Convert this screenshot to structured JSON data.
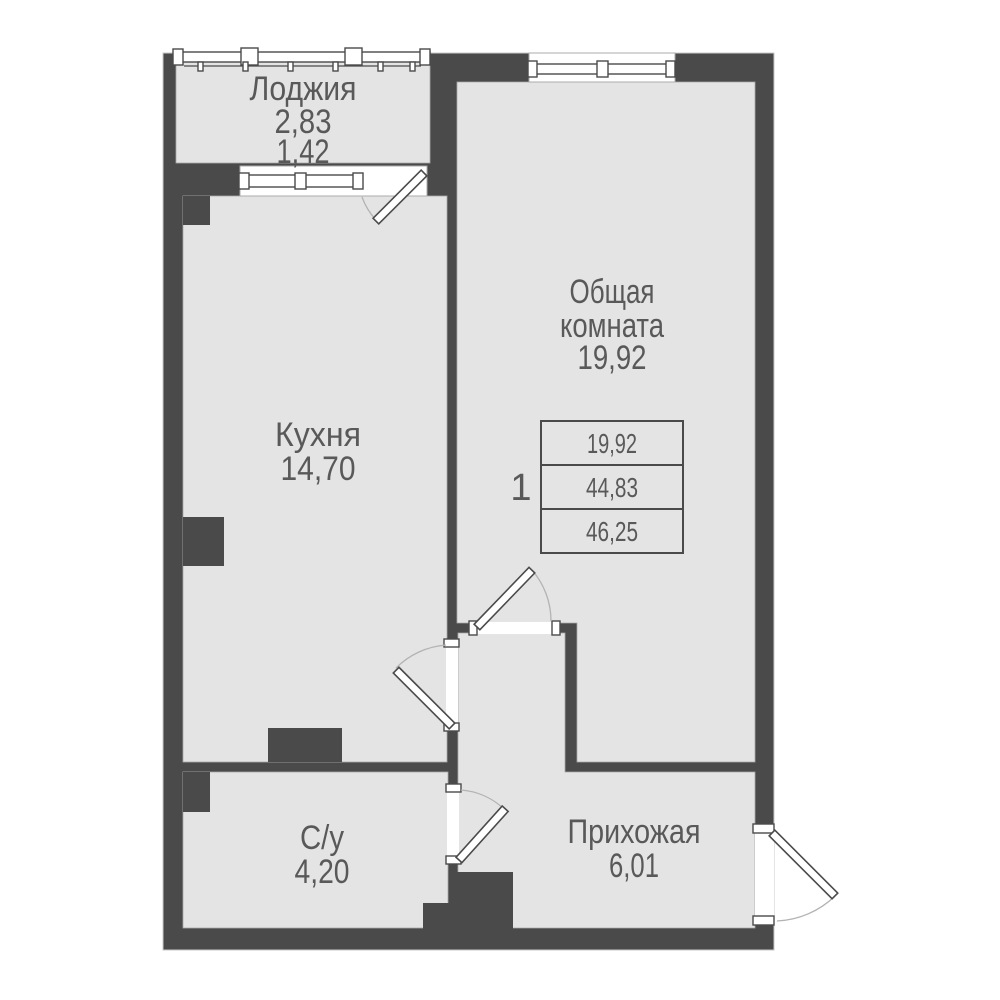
{
  "colors": {
    "wall": "#4a4a4a",
    "floor": "#e4e4e4",
    "floor-edge": "#a8a8a8",
    "door-arc": "#b3b3b3",
    "text": "#595959",
    "background": "#ffffff"
  },
  "flat_number": "1",
  "rooms": {
    "loggia": {
      "name": "Лоджия",
      "area_full": "2,83",
      "area_reduced": "1,42"
    },
    "kitchen": {
      "name": "Кухня",
      "area": "14,70"
    },
    "living": {
      "name_line1": "Общая",
      "name_line2": "комната",
      "area": "19,92"
    },
    "bathroom": {
      "name": "С/у",
      "area": "4,20"
    },
    "hallway": {
      "name": "Прихожая",
      "area": "6,01"
    }
  },
  "area_table": {
    "rows": [
      "19,92",
      "44,83",
      "46,25"
    ]
  }
}
